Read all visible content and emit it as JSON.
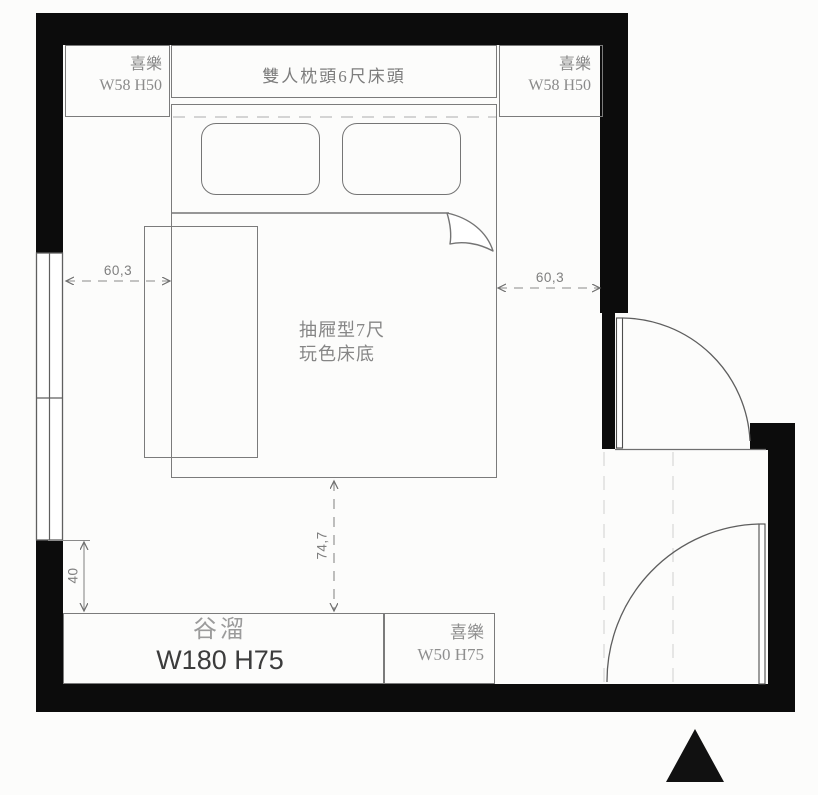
{
  "drawing": {
    "kind": "bedroom-floor-plan"
  },
  "furniture": {
    "cabinet_top_left": {
      "name": "喜樂",
      "size": "W58 H50"
    },
    "headboard": {
      "label": "雙人枕頭6尺床頭"
    },
    "cabinet_top_right": {
      "name": "喜樂",
      "size": "W58 H50"
    },
    "bed": {
      "label_line1": "抽屜型7尺",
      "label_line2": "玩色床底"
    },
    "cabinet_bottom_large": {
      "name": "谷溜",
      "size": "W180 H75"
    },
    "cabinet_bottom_small": {
      "name": "喜樂",
      "size": "W50 H75"
    }
  },
  "dimensions": {
    "left_gap": "60,3",
    "right_gap": "60,3",
    "bed_to_cabinet": "74,7",
    "window_to_cabinet": "40"
  },
  "colors": {
    "wall": "#0c0c0c",
    "furniture_line": "#7b7b7b",
    "dimension_line": "#8a8a8a",
    "label_light": "#8f8f8f",
    "label_dark": "#3c3c3c"
  }
}
